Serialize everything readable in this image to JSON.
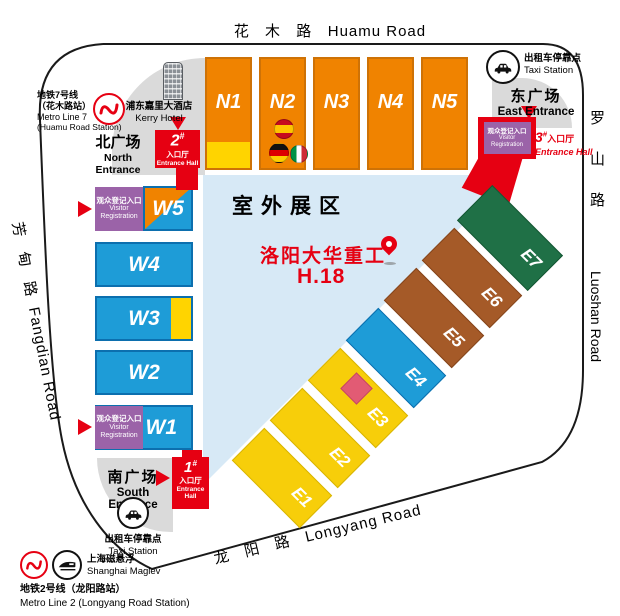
{
  "colors": {
    "accent_red": "#E60012",
    "hall_orange": "#F08300",
    "hall_blue": "#1E9CD7",
    "hall_yellow": "#F7CE0A",
    "hall_brown": "#A55A28",
    "hall_green": "#1F7046",
    "registration_purple": "#9B63A8",
    "outdoor_light_blue": "#D7E9F6",
    "plaza_gray": "#DADADA",
    "booth_pink": "#E25B74"
  },
  "roads": {
    "huamu": {
      "zh": "花 木 路",
      "en": "Huamu Road"
    },
    "luoshan": {
      "zh": "罗山路",
      "en": "Luoshan Road"
    },
    "fangdian": {
      "zh": "芳 甸 路",
      "en": "Fangdian Road"
    },
    "longyang": {
      "zh": "龙 阳 路",
      "en": "Longyang Road"
    }
  },
  "halls": {
    "north": [
      "N1",
      "N2",
      "N3",
      "N4",
      "N5"
    ],
    "west": [
      "W5",
      "W4",
      "W3",
      "W2",
      "W1"
    ],
    "east": [
      "E1",
      "E2",
      "E3",
      "E4",
      "E5",
      "E6",
      "E7"
    ]
  },
  "outdoor_area": {
    "label": "室外展区"
  },
  "booth": {
    "exhibitor": "洛阳大华重工",
    "number": "H.18"
  },
  "entrances": {
    "north": {
      "zh": "北广场",
      "en_l1": "North",
      "en_l2": "Entrance"
    },
    "east": {
      "zh": "东广场",
      "en": "East Entrance"
    },
    "south": {
      "zh": "南广场",
      "en": "South Entrance"
    }
  },
  "entrance_halls": {
    "h1": {
      "num": "1",
      "hash": "#",
      "zh": "入口厅",
      "en_l1": "Entrance",
      "en_l2": "Hall"
    },
    "h2": {
      "num": "2",
      "hash": "#",
      "zh": "入口厅",
      "en": "Entrance Hall"
    },
    "h3": {
      "num": "3",
      "hash": "#",
      "zh": "入口厅",
      "en": "Entrance Hall"
    }
  },
  "registration": {
    "zh": "观众登记入口",
    "en_l1": "Visitor",
    "en_l2": "Registration"
  },
  "taxi": {
    "zh": "出租车停靠点",
    "en": "Taxi Station"
  },
  "transit": {
    "line7": {
      "zh_l1": "地铁7号线",
      "zh_l2": "（花木路站）",
      "en_l1": "Metro Line 7",
      "en_l2": "(Huamu Road Station)"
    },
    "maglev": {
      "zh": "上海磁悬浮",
      "en": "Shanghai Maglev"
    },
    "line2": {
      "zh": "地铁2号线（龙阳路站）",
      "en": "Metro Line 2 (Longyang Road Station)"
    }
  },
  "hotel": {
    "zh": "浦东嘉里大酒店",
    "en": "Kerry Hotel"
  }
}
